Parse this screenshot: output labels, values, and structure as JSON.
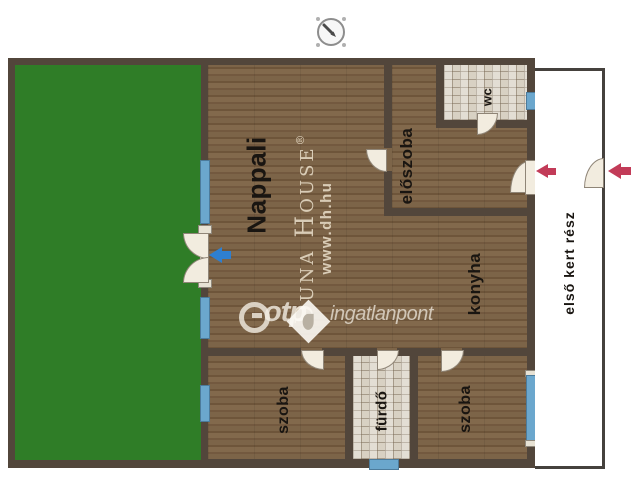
{
  "labels": {
    "nappali": "Nappali",
    "eloszoba": "előszoba",
    "wc": "wc",
    "konyha": "konyha",
    "szoba_left": "szoba",
    "furdo": "fürdő",
    "szoba_right": "szoba",
    "front_garden": "első kert rész"
  },
  "watermarks": {
    "otp_brand": "otp",
    "otp_suffix": "ingatlanpont",
    "dunahouse_name": "Duna House",
    "dunahouse_reg": "®",
    "dunahouse_url": "www.dh.hu"
  },
  "icons": {
    "compass": "compass-rose-icon",
    "otp_logo": "otp-circle-logo",
    "dunahouse_logo": "duna-house-diamond-logo"
  },
  "colors": {
    "wall": "#52463b",
    "floor_base": "#7a6247",
    "garden": "#2f7d27",
    "tile": "#d8d1c3",
    "window": "#6ba7cd",
    "door_leaf": "#f2ecdf",
    "red_arrow": "#c23b58",
    "blue_arrow": "#2e7fd0",
    "label": "#191511",
    "watermark": "rgba(243,238,227,0.8)",
    "watermark_beige": "rgba(230,219,198,0.88)"
  }
}
